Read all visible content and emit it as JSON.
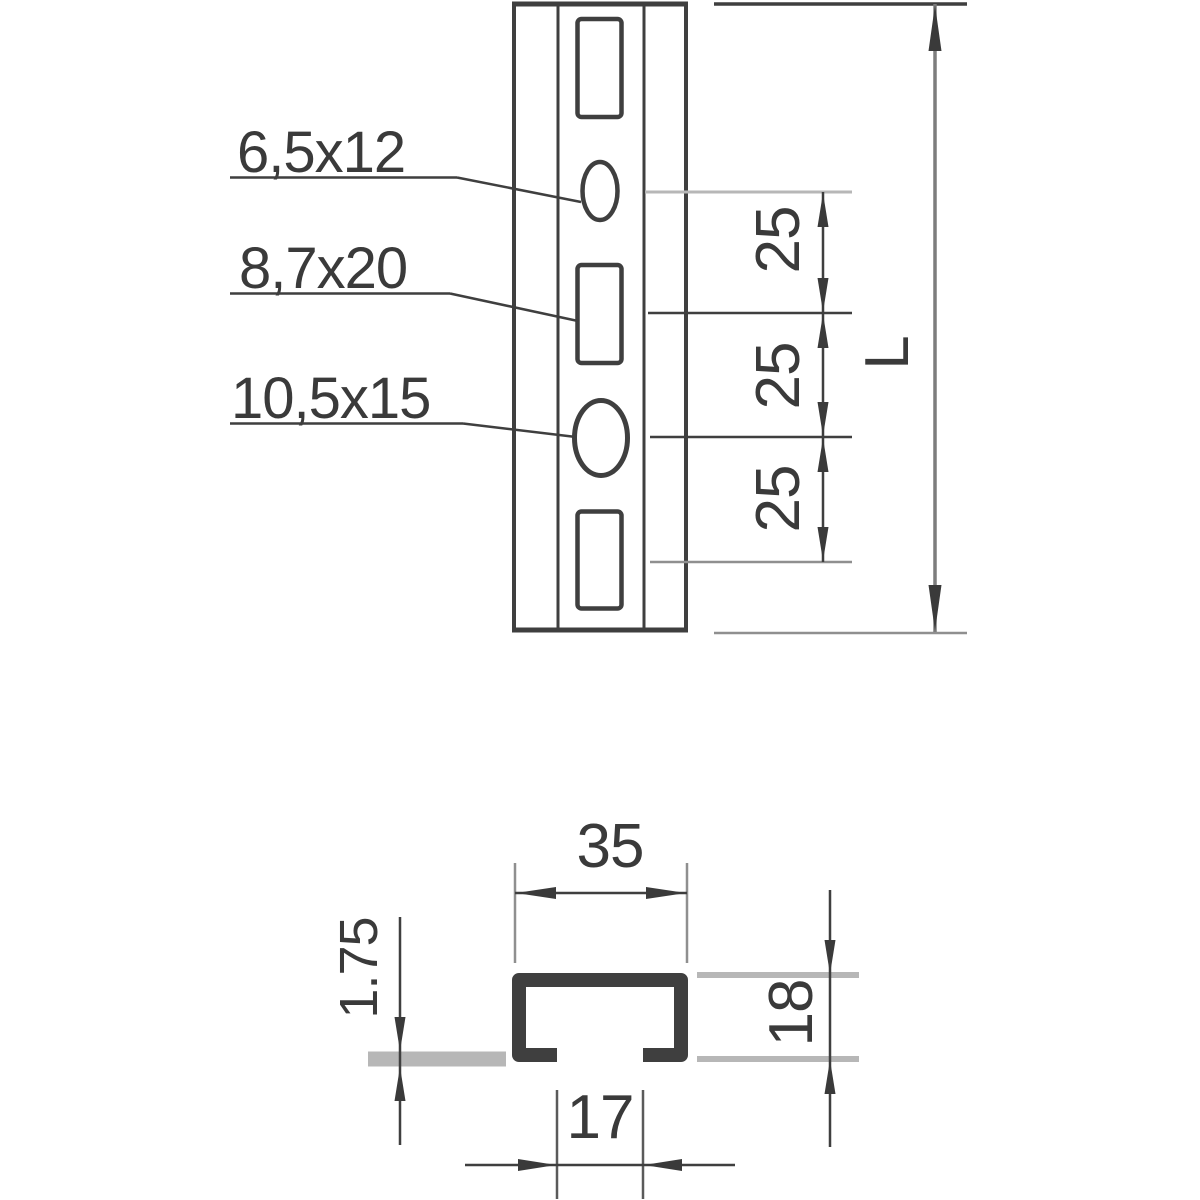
{
  "drawing": {
    "type": "technical-drawing-channel-rail",
    "front_view": {
      "hole_labels": [
        {
          "text": "6,5x12"
        },
        {
          "text": "8,7x20"
        },
        {
          "text": "10,5x15"
        }
      ],
      "pitch_dims": [
        "25",
        "25",
        "25"
      ],
      "length_dim": "L"
    },
    "section_view": {
      "width_dim": "35",
      "thickness_dim": "1.75",
      "height_dim": "18",
      "opening_dim": "17"
    },
    "colors": {
      "background": "#ffffff",
      "line_dark": "#3f3f3f",
      "line_medium": "#8f8f8f",
      "line_light": "#b7b7b7",
      "text": "#3a3a3a"
    }
  }
}
